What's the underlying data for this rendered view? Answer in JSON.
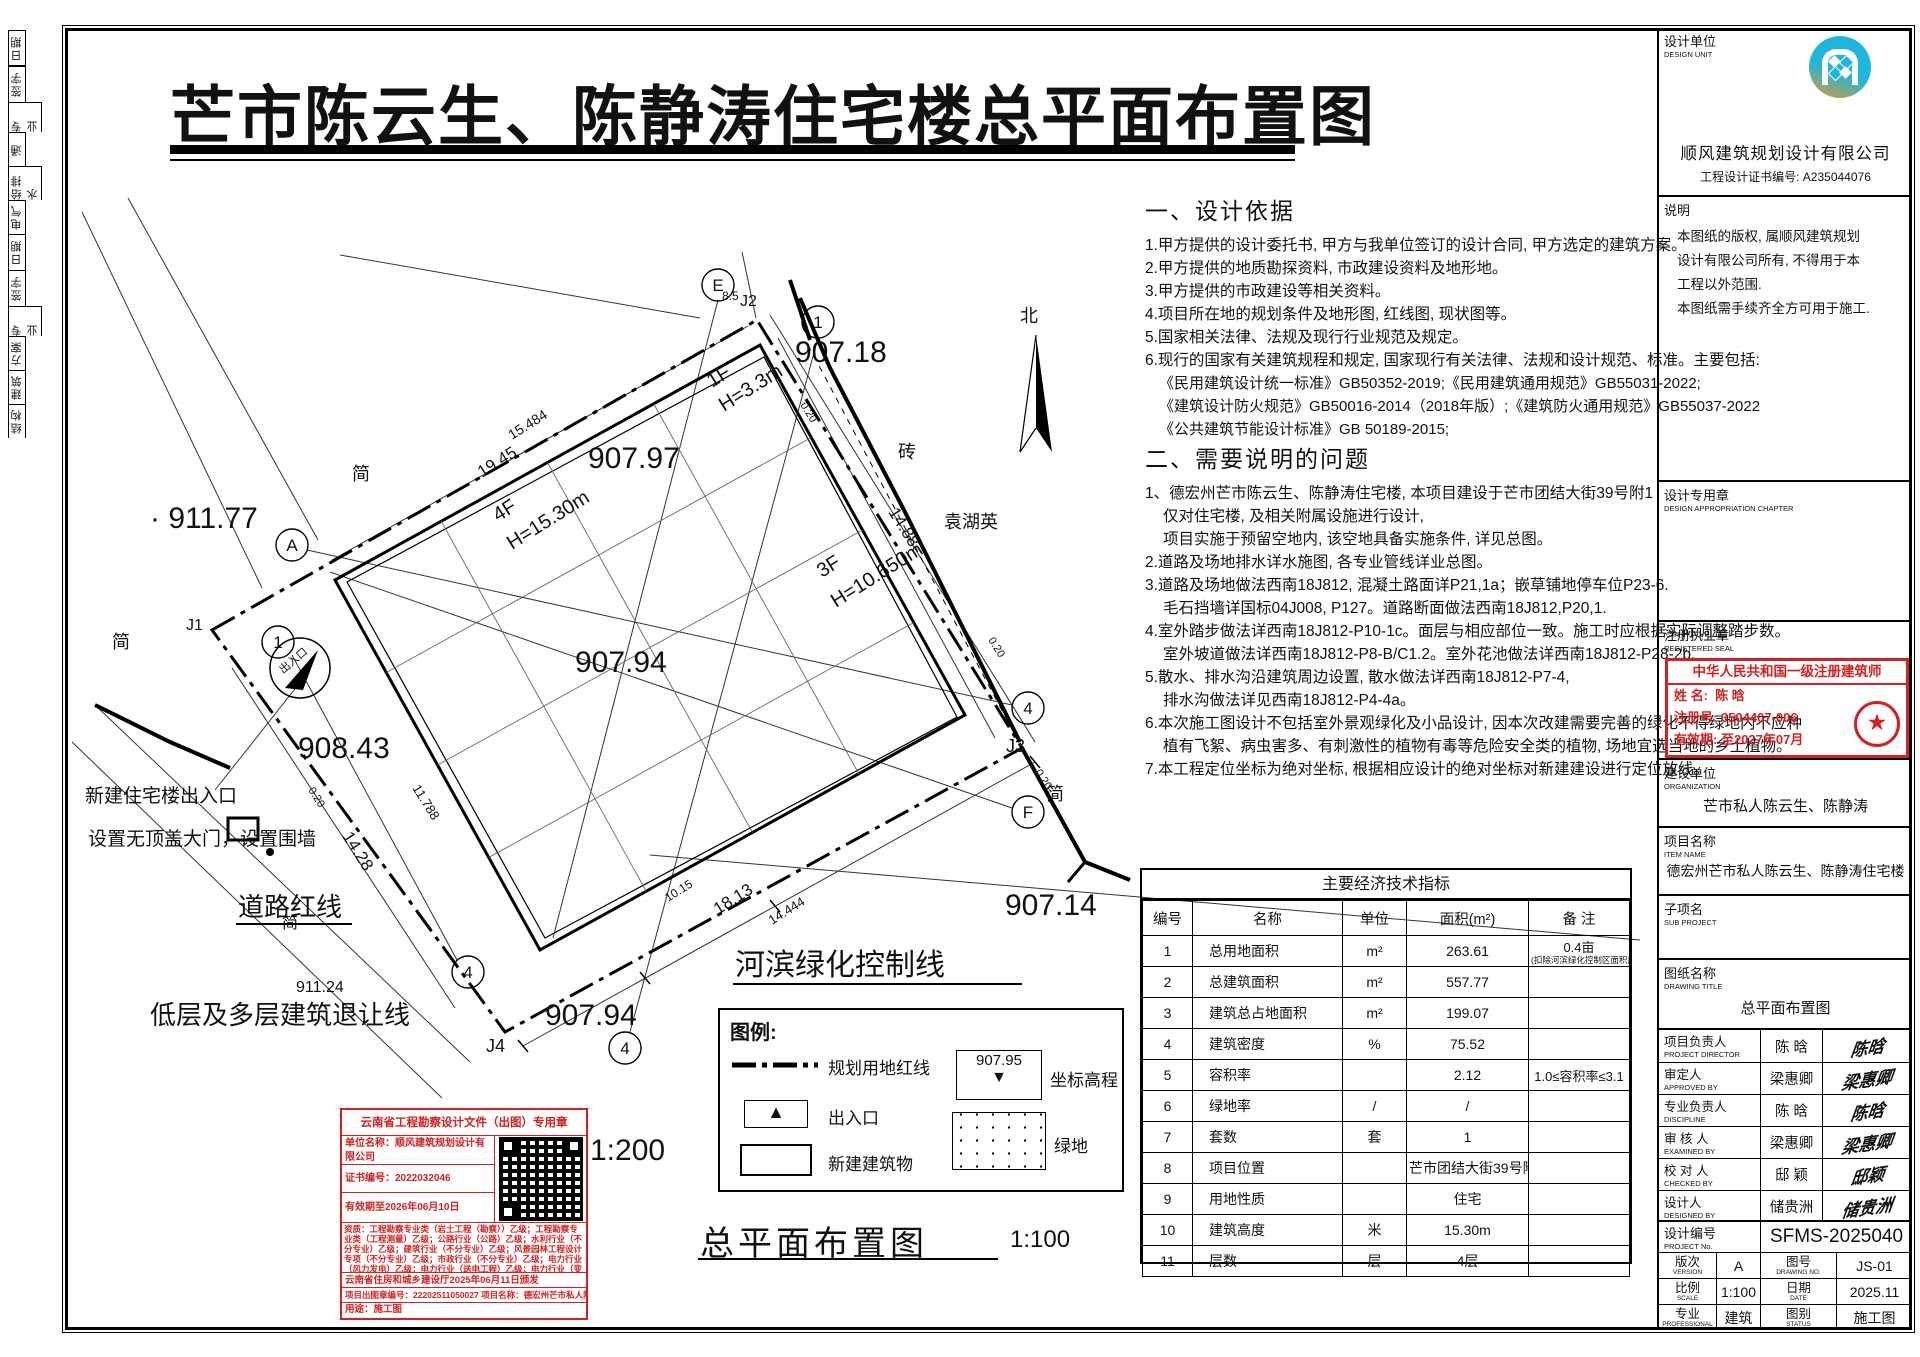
{
  "title": "芒市陈云生、陈静涛住宅楼总平面布置图",
  "left_strip": {
    "cells": [
      "日期",
      "签字",
      "专 业",
      "通",
      "给排水",
      "电气",
      "日期",
      "签字",
      "专 业",
      "方案",
      "建筑",
      "结构"
    ]
  },
  "notes": {
    "section1_title": "一、设计依据",
    "section1_items": [
      "1.甲方提供的设计委托书, 甲方与我单位签订的设计合同, 甲方选定的建筑方案。",
      "2.甲方提供的地质勘探资料, 市政建设资料及地形地。",
      "3.甲方提供的市政建设等相关资料。",
      "4.项目所在地的规划条件及地形图, 红线图, 现状图等。",
      "5.国家相关法律、法规及现行行业规范及规定。",
      "6.现行的国家有关建筑规程和规定, 国家现行有关法律、法规和设计规范、标准。主要包括:",
      "《民用建筑设计统一标准》GB50352-2019;《民用建筑通用规范》GB55031-2022;",
      "《建筑设计防火规范》GB50016-2014（2018年版）;《建筑防火通用规范》GB55037-2022",
      "《公共建筑节能设计标准》GB 50189-2015;"
    ],
    "section2_title": "二、需要说明的问题",
    "section2_items": [
      "1、德宏州芒市陈云生、陈静涛住宅楼, 本项目建设于芒市团结大街39号附1",
      "仅对住宅楼, 及相关附属设施进行设计,",
      "项目实施于预留空地内, 该空地具备实施条件, 详见总图。",
      "2.道路及场地排水详水施图, 各专业管线详业总图。",
      "3.道路及场地做法西南18J812, 混凝土路面详P21,1a；嵌草铺地停车位P23-6.",
      "毛石挡墙详国标04J008, P127。道路断面做法西南18J812,P20,1.",
      "4.室外踏步做法详西南18J812-P10-1c。面层与相应部位一致。施工时应根据实际调整踏步数。",
      "室外坡道做法详西南18J812-P8-B/C1.2。室外花池做法详西南18J812-P28-2b.",
      "5.散水、排水沟沿建筑周边设置, 散水做法详西南18J812-P7-4,",
      "排水沟做法详见西南18J812-P4-4a。",
      "6.本次施工图设计不包括室外景观绿化及小品设计, 因本次改建需要完善的绿化不得绿地内不应种",
      "植有飞絮、病虫害多、有刺激性的植物有毒等危险安全类的植物, 场地宜选当地的乡土植物。",
      "7.本工程定位坐标为绝对坐标, 根据相应设计的绝对坐标对新建建设进行定位放线。"
    ]
  },
  "plan": {
    "north_label": "北",
    "labels": [
      {
        "text": "· 911.77",
        "x": 150,
        "y": 528,
        "size": 30
      },
      {
        "text": "907.18",
        "x": 795,
        "y": 362,
        "size": 30
      },
      {
        "text": "907.97",
        "x": 588,
        "y": 468,
        "size": 30
      },
      {
        "text": "907.94",
        "x": 575,
        "y": 672,
        "size": 30
      },
      {
        "text": "908.43",
        "x": 298,
        "y": 758,
        "size": 30
      },
      {
        "text": "907.14",
        "x": 1005,
        "y": 915,
        "size": 30
      },
      {
        "text": "907.94",
        "x": 545,
        "y": 1025,
        "size": 30
      },
      {
        "text": "911.24",
        "x": 296,
        "y": 992,
        "size": 16
      },
      {
        "text": "1F",
        "x": 712,
        "y": 388,
        "size": 20,
        "rotate": -32
      },
      {
        "text": "H=3.3m",
        "x": 724,
        "y": 412,
        "size": 20,
        "rotate": -32
      },
      {
        "text": "4F",
        "x": 498,
        "y": 522,
        "size": 20,
        "rotate": -32
      },
      {
        "text": "H=15.30m",
        "x": 512,
        "y": 550,
        "size": 20,
        "rotate": -32
      },
      {
        "text": "3F",
        "x": 822,
        "y": 578,
        "size": 20,
        "rotate": -32
      },
      {
        "text": "H=10.650m",
        "x": 836,
        "y": 608,
        "size": 20,
        "rotate": -32
      },
      {
        "text": "15.484",
        "x": 512,
        "y": 440,
        "size": 14,
        "rotate": -32
      },
      {
        "text": "19.45",
        "x": 482,
        "y": 478,
        "size": 17,
        "rotate": -32
      },
      {
        "text": "14.88",
        "x": 888,
        "y": 512,
        "size": 17,
        "rotate": 58
      },
      {
        "text": "14.28",
        "x": 342,
        "y": 836,
        "size": 17,
        "rotate": 58
      },
      {
        "text": "11.788",
        "x": 412,
        "y": 788,
        "size": 13,
        "rotate": 58
      },
      {
        "text": "18.13",
        "x": 718,
        "y": 915,
        "size": 17,
        "rotate": -32
      },
      {
        "text": "14.444",
        "x": 772,
        "y": 925,
        "size": 13,
        "rotate": -32
      },
      {
        "text": "10.15",
        "x": 668,
        "y": 902,
        "size": 12,
        "rotate": -32
      },
      {
        "text": "0.20",
        "x": 800,
        "y": 405,
        "size": 11,
        "rotate": 58
      },
      {
        "text": "0.20",
        "x": 988,
        "y": 640,
        "size": 11,
        "rotate": 58
      },
      {
        "text": "0.20",
        "x": 1035,
        "y": 772,
        "size": 11,
        "rotate": 58
      },
      {
        "text": "0.20",
        "x": 308,
        "y": 790,
        "size": 11,
        "rotate": 58
      },
      {
        "text": "8.5",
        "x": 722,
        "y": 300,
        "size": 12
      },
      {
        "text": "J2",
        "x": 740,
        "y": 306,
        "size": 16
      },
      {
        "text": "J1",
        "x": 186,
        "y": 630,
        "size": 16
      },
      {
        "text": "J3",
        "x": 1006,
        "y": 752,
        "size": 18
      },
      {
        "text": "J4",
        "x": 486,
        "y": 1052,
        "size": 18
      },
      {
        "text": "砖",
        "x": 898,
        "y": 458,
        "size": 18
      },
      {
        "text": "袁湖英",
        "x": 944,
        "y": 528,
        "size": 18
      },
      {
        "text": "简",
        "x": 352,
        "y": 480,
        "size": 18
      },
      {
        "text": "简",
        "x": 112,
        "y": 648,
        "size": 18
      },
      {
        "text": "简",
        "x": 1046,
        "y": 800,
        "size": 18
      },
      {
        "text": "简",
        "x": 282,
        "y": 928,
        "size": 16
      },
      {
        "text": "北",
        "x": 1020,
        "y": 322,
        "size": 18
      },
      {
        "text": "出入口",
        "x": 283,
        "y": 674,
        "size": 11,
        "rotate": -40
      },
      {
        "text": "新建住宅楼出入口",
        "x": 85,
        "y": 802,
        "size": 19
      },
      {
        "text": "设置无顶盖大门，设置围墙",
        "x": 88,
        "y": 845,
        "size": 19
      },
      {
        "text": "道路红线",
        "x": 238,
        "y": 916,
        "size": 26,
        "underline": true
      },
      {
        "text": "低层及多层建筑退让线",
        "x": 150,
        "y": 1024,
        "size": 26
      },
      {
        "text": "河滨绿化控制线",
        "x": 735,
        "y": 975,
        "size": 30,
        "underline": true
      },
      {
        "text": "1:200",
        "x": 590,
        "y": 1160,
        "size": 30
      }
    ],
    "axis_circles": [
      {
        "label": "E",
        "x": 718,
        "y": 285
      },
      {
        "label": "1",
        "x": 818,
        "y": 322
      },
      {
        "label": "A",
        "x": 292,
        "y": 545
      },
      {
        "label": "1",
        "x": 278,
        "y": 642
      },
      {
        "label": "4",
        "x": 1028,
        "y": 708
      },
      {
        "label": "F",
        "x": 1028,
        "y": 812
      },
      {
        "label": "4",
        "x": 468,
        "y": 972
      },
      {
        "label": "4",
        "x": 625,
        "y": 1048
      }
    ],
    "legend": {
      "title": "图例:",
      "items": [
        {
          "label": "规划用地红线"
        },
        {
          "label": "出入口"
        },
        {
          "label": "新建建筑物"
        },
        {
          "label": "坐标高程",
          "value": "907.95"
        },
        {
          "label": "绿地"
        }
      ]
    },
    "bottom_title": "总平面布置图",
    "bottom_scale": "1:100"
  },
  "indicators": {
    "title": "主要经济技术指标",
    "headers": [
      "编号",
      "名称",
      "单位",
      "面积(m²)",
      "备 注"
    ],
    "rows": [
      {
        "no": "1",
        "name": "总用地面积",
        "unit": "m²",
        "value": "263.61",
        "note": "0.4亩",
        "note2": "(扣除河滨绿化控制区面积后)"
      },
      {
        "no": "2",
        "name": "总建筑面积",
        "unit": "m²",
        "value": "557.77",
        "note": "",
        "note2": ""
      },
      {
        "no": "3",
        "name": "建筑总占地面积",
        "unit": "m²",
        "value": "199.07",
        "note": "",
        "note2": ""
      },
      {
        "no": "4",
        "name": "建筑密度",
        "unit": "%",
        "value": "75.52",
        "note": "",
        "note2": ""
      },
      {
        "no": "5",
        "name": "容积率",
        "unit": "",
        "value": "2.12",
        "note": "1.0≤容积率≤3.1",
        "note2": ""
      },
      {
        "no": "6",
        "name": "绿地率",
        "unit": "/",
        "value": "/",
        "note": "",
        "note2": ""
      },
      {
        "no": "7",
        "name": "套数",
        "unit": "套",
        "value": "1",
        "note": "",
        "note2": ""
      },
      {
        "no": "8",
        "name": "项目位置",
        "unit": "",
        "value": "芒市团结大街39号附1",
        "note": "",
        "note2": ""
      },
      {
        "no": "9",
        "name": "用地性质",
        "unit": "",
        "value": "住宅",
        "note": "",
        "note2": ""
      },
      {
        "no": "10",
        "name": "建筑高度",
        "unit": "米",
        "value": "15.30m",
        "note": "",
        "note2": ""
      },
      {
        "no": "11",
        "name": "层数",
        "unit": "层",
        "value": "4层",
        "note": "",
        "note2": ""
      }
    ]
  },
  "stamp_box": {
    "title": "云南省工程勘察设计文件（出图）专用章",
    "rows": [
      "单位名称：顺风建筑规划设计有限公司",
      "证书编号：2022032046",
      "有效期至2026年06月10日"
    ],
    "qualifications": "资质：工程勘察专业类（岩土工程（勘察））乙级；工程勘察专业类（工程测量）乙级；公路行业（公路）乙级；水利行业（不分专业）乙级；建筑行业（不分专业）乙级；风景园林工程设计专项（不分专业）乙级；市政行业（不分专业）乙级；电力行业（风力发电）乙级；电力行业（送电工程）乙级；电力行业（变电工程）乙级；化工石油医药行业（不分专业）乙级；环境工程设计专项（物理污染防治工程）乙级；农林行业（农业综合开发生态工程）乙级",
    "issuer": "云南省住房和城乡建设厅2025年06月11日颁发",
    "project_line": "项目出图章编号：22202511050027 项目名称：德宏州芒市私人陈云生、陈静涛住宅楼",
    "usage": "用途：施工图"
  },
  "right_panel": {
    "design_unit": {
      "label": "设计单位",
      "en": "DESIGN UNIT",
      "company": "顺风建筑规划设计有限公司",
      "cert": "工程设计证书编号: A235044076"
    },
    "notice": {
      "label": "说明",
      "lines": [
        "本图纸的版权, 属顺风建筑规划",
        "设计有限公司所有, 不得用于本",
        "工程以外范围.",
        "本图纸需手续齐全方可用于施工."
      ]
    },
    "chapter": {
      "label": "设计专用章",
      "en": "DESIGN APPROPRIATION CHAPTER"
    },
    "seal": {
      "label": "注册执业章",
      "en": "REGISTERED SEAL",
      "stamp_title": "中华人民共和国一级注册建筑师",
      "name_label": "姓 名:",
      "name": "陈  晗",
      "reg_label": "注册号:",
      "reg": "3504407-006",
      "valid_label": "有效期:",
      "valid": "至2027年07月"
    },
    "org": {
      "label": "建设单位",
      "en": "ORGANIZATION",
      "value": "芒市私人陈云生、陈静涛"
    },
    "item": {
      "label": "项目名称",
      "en": "ITEM NAME",
      "value": "德宏州芒市私人陈云生、陈静涛住宅楼"
    },
    "sub": {
      "label": "子项名",
      "en": "SUB PROJECT",
      "value": ""
    },
    "drawing": {
      "label": "图纸名称",
      "en": "DRAWING TITLE",
      "value": "总平面布置图"
    },
    "personnel": [
      {
        "label": "项目负责人",
        "en": "PROJECT DIRECTOR",
        "name": "陈  晗"
      },
      {
        "label": "审定人",
        "en": "APPROVED BY",
        "name": "梁惠卿"
      },
      {
        "label": "专业负责人",
        "en": "DISCIPLINE RESPONSIBLE BY",
        "name": "陈  晗"
      },
      {
        "label": "审 核 人",
        "en": "EXAMINED BY",
        "name": "梁惠卿"
      },
      {
        "label": "校 对 人",
        "en": "CHECKED BY",
        "name": "邸  颖"
      },
      {
        "label": "设计人",
        "en": "DESIGNED BY",
        "name": "储贵洲"
      }
    ],
    "project_no": {
      "label": "设计编号",
      "en": "PROJECT No.",
      "value": "SFMS-2025040"
    },
    "meta": [
      {
        "label": "版次",
        "en": "VERSION",
        "value": "A",
        "label2": "图号",
        "en2": "DRAWING NO.",
        "value2": "JS-01"
      },
      {
        "label": "比例",
        "en": "SCALE",
        "value": "1:100",
        "label2": "日期",
        "en2": "DATE",
        "value2": "2025.11"
      },
      {
        "label": "专业",
        "en": "PROFESSIONAL",
        "value": "建筑",
        "label2": "图别",
        "en2": "STATUS",
        "value2": "施工图"
      }
    ]
  }
}
